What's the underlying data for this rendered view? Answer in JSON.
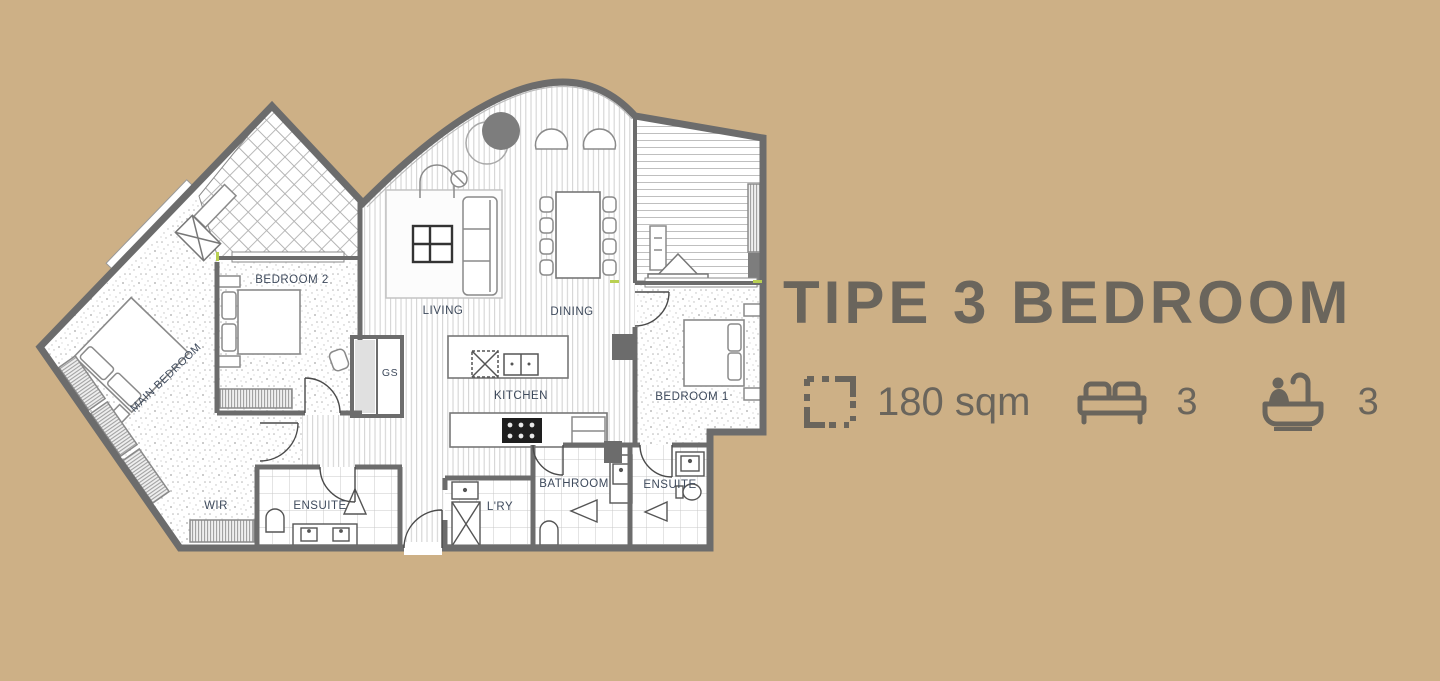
{
  "colors": {
    "background": "#cdb086",
    "heading_text": "#6a655c",
    "walls": "#6c6c6c",
    "room_label_text": "#3e4a5c"
  },
  "heading": {
    "title": "TIPE 3 BEDROOM"
  },
  "stats": {
    "area": {
      "icon": "area-outline-icon",
      "value": "180 sqm"
    },
    "bedrooms": {
      "icon": "bed-icon",
      "value": "3"
    },
    "bathrooms": {
      "icon": "bath-icon",
      "value": "3"
    }
  },
  "floor_plan": {
    "rooms": {
      "main_bedroom": "MAIN BEDROOM",
      "bedroom_2": "BEDROOM 2",
      "living": "LIVING",
      "dining": "DINING",
      "kitchen": "KITCHEN",
      "bedroom_1": "BEDROOM 1",
      "wir": "WIR",
      "ensuite_left": "ENSUITE",
      "laundry": "L'RY",
      "bathroom": "BATHROOM",
      "ensuite_right": "ENSUITE",
      "gs": "GS"
    }
  }
}
